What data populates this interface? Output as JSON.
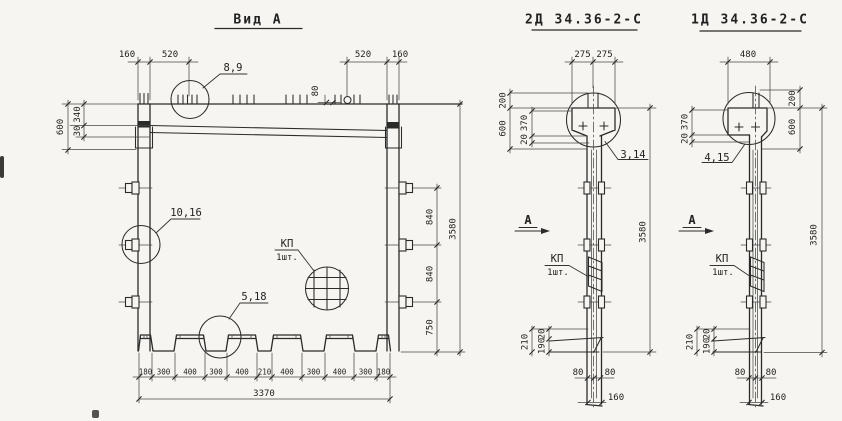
{
  "colors": {
    "paper": "#f6f5f1",
    "ink": "#2b2b2b",
    "dim_line": "#474747"
  },
  "views": {
    "vid_a": {
      "title": "Вид А",
      "top_dims": {
        "left_160": "160",
        "left_520": "520",
        "right_520": "520",
        "right_160": "160",
        "tick_spacing": "80"
      },
      "left_dims": {
        "h600": "600",
        "h340": "340",
        "h30": "30"
      },
      "right_dims": {
        "s840a": "840",
        "s840b": "840",
        "s750": "750",
        "total": "3580"
      },
      "bottom_dims": [
        "180",
        "300",
        "400",
        "300",
        "400",
        "210",
        "400",
        "300",
        "400",
        "300",
        "180"
      ],
      "bottom_total": "3370",
      "callouts": {
        "pos_8_9": "8,9",
        "pos_10_16": "10,16",
        "pos_5_18": "5,18",
        "mesh_label": "КП",
        "mesh_qty": "1шт."
      }
    },
    "col_2d": {
      "title": "2Д 34.36-2-С",
      "top_dims": [
        "275",
        "275"
      ],
      "left_dims": {
        "h200": "200",
        "h600": "600",
        "h370": "370",
        "h20": "20"
      },
      "callout": "3,14",
      "section_mark": "А",
      "mesh_label": "КП",
      "mesh_qty": "1шт.",
      "height_total": "3580",
      "base_dims": {
        "h210": "210",
        "h190": "190",
        "h20": "20"
      },
      "bottom_dims": {
        "left80": "80",
        "right80": "80",
        "w160": "160"
      }
    },
    "col_1d": {
      "title": "1Д 34.36-2-С",
      "top_dim": "480",
      "left_dims": {
        "h370": "370",
        "h20": "20"
      },
      "right_dims": {
        "h200": "200",
        "h600": "600"
      },
      "callout": "4,15",
      "section_mark": "А",
      "mesh_label": "КП",
      "mesh_qty": "1шт.",
      "height_total": "3580",
      "base_dims": {
        "h210": "210",
        "h190": "190",
        "h20": "20"
      },
      "bottom_dims": {
        "left80": "80",
        "right80": "80",
        "w160": "160"
      }
    }
  }
}
